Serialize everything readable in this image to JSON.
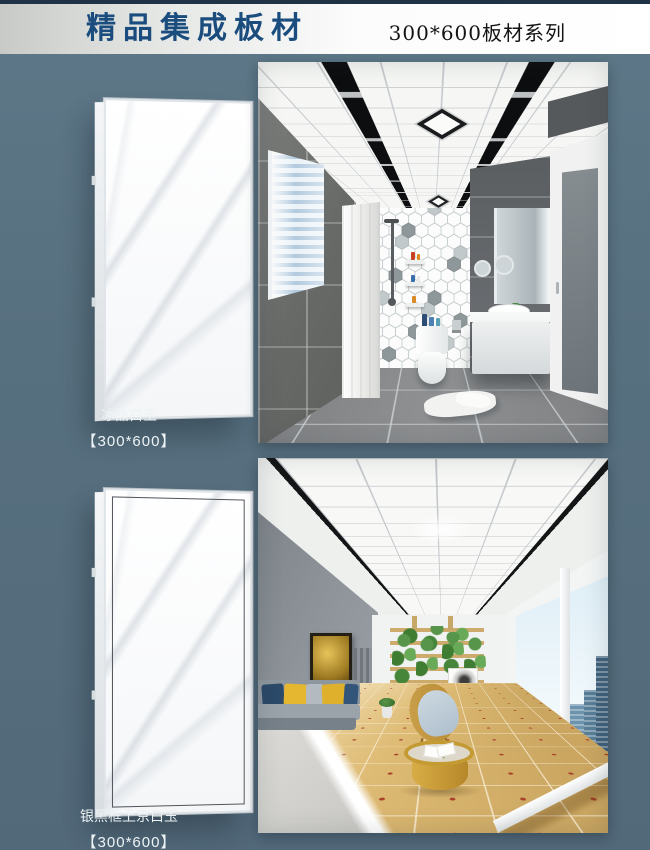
{
  "header": {
    "title": "精品集成板材",
    "series_label": "300*600板材系列"
  },
  "products": [
    {
      "name": "冰晶白玉",
      "size": "【300*600】"
    },
    {
      "name": "银黑框上京白玉",
      "size": "【300*600】"
    }
  ],
  "colors": {
    "page_background": "#57707f",
    "top_bar": "#203246",
    "title_blue": "#1a4c7e",
    "series_text": "#141414",
    "label_text": "#edf3f5",
    "panel_marble": "#fdfdfe",
    "panel_black_frame": "#4e545a"
  }
}
